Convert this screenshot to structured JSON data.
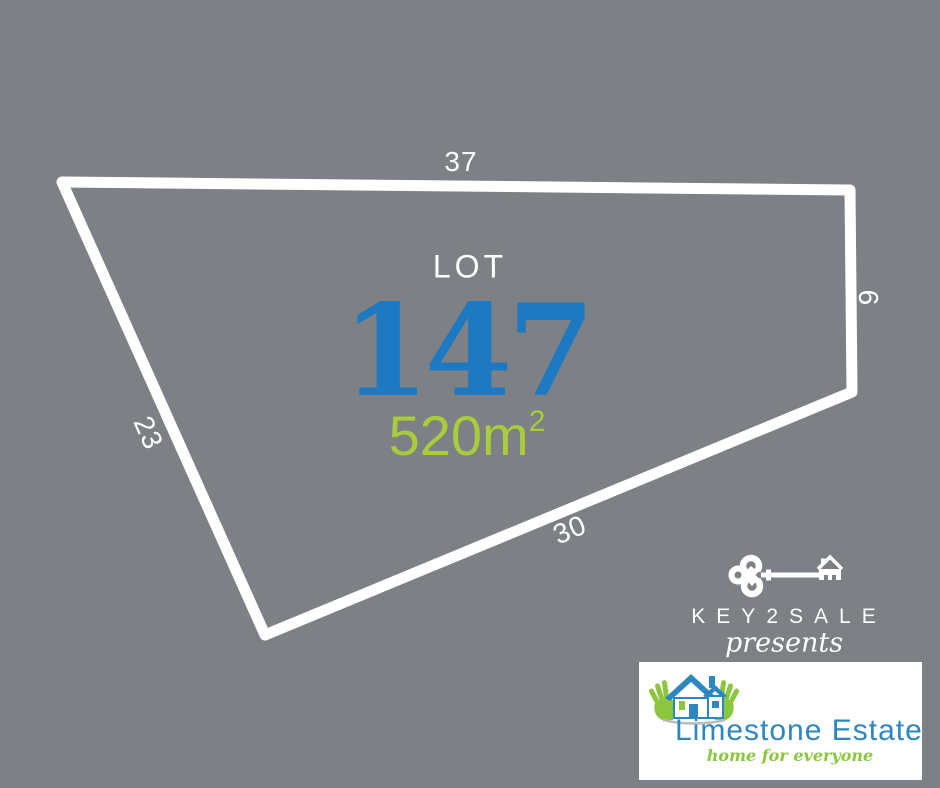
{
  "colors": {
    "background": "#7d8084",
    "outline_white": "#ffffff",
    "lot_number_blue": "#1d7ac2",
    "area_green": "#a8cc3c",
    "limestone_blue": "#2e86c1",
    "limestone_green": "#8cc63f"
  },
  "lot": {
    "label": "LOT",
    "number": "147",
    "area_base": "520m",
    "area_exponent": "2",
    "dim_top": "37",
    "dim_right": "9",
    "dim_bottom": "30",
    "dim_left": "23"
  },
  "key2sale": {
    "name": "KEY2SALE",
    "tagline": "presents"
  },
  "limestone": {
    "name": "Limestone Estate",
    "tagline": "home for everyone"
  }
}
